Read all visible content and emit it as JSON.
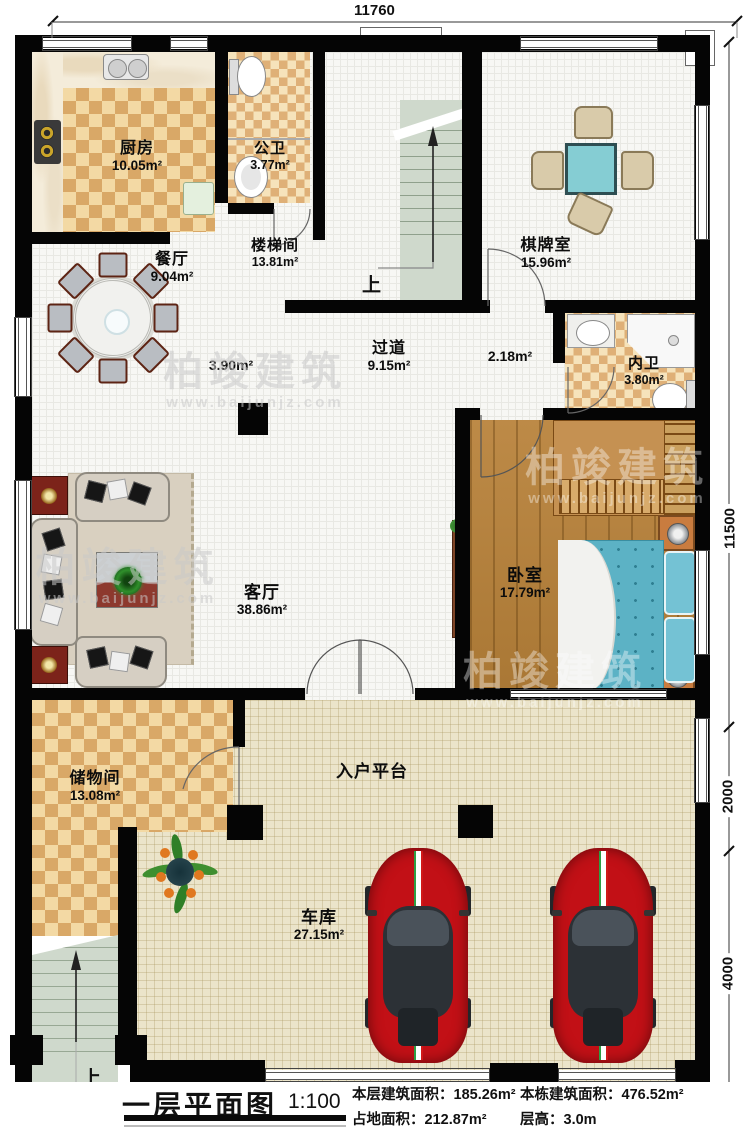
{
  "drawing": {
    "type": "floor-plan",
    "title": "一层平面图",
    "scale": "1:100"
  },
  "rooms": {
    "kitchen": {
      "name": "厨房",
      "area": "10.05m²"
    },
    "public_bath": {
      "name": "公卫",
      "area": "3.77m²"
    },
    "dining": {
      "name": "餐厅",
      "area": "9.04m²"
    },
    "stairwell": {
      "name": "楼梯间",
      "area": "13.81m²"
    },
    "chess": {
      "name": "棋牌室",
      "area": "15.96m²"
    },
    "hallway": {
      "name": "过道",
      "area": "9.15m²"
    },
    "hallway_sub1": {
      "area": "3.90m²"
    },
    "hallway_sub2": {
      "area": "2.18m²"
    },
    "inner_bath": {
      "name": "内卫",
      "area": "3.80m²"
    },
    "bedroom": {
      "name": "卧室",
      "area": "17.79m²"
    },
    "living": {
      "name": "客厅",
      "area": "38.86m²"
    },
    "storage": {
      "name": "储物间",
      "area": "13.08m²"
    },
    "platform": {
      "name": "入户平台"
    },
    "garage": {
      "name": "车库",
      "area": "27.15m²"
    }
  },
  "stairs": {
    "up_label": "上"
  },
  "dimensions": {
    "top": "11760",
    "right_upper": "11500",
    "right_mid": "2000",
    "right_lower": "4000"
  },
  "title_block": {
    "title": "一层平面图",
    "scale": "1:100",
    "floor_area_label": "本层建筑面积：",
    "floor_area_value": "185.26m²",
    "footprint_label": "占地面积：",
    "footprint_value": "212.87m²",
    "total_area_label": "本栋建筑面积：",
    "total_area_value": "476.52m²",
    "storey_height_label": "层高：",
    "storey_height_value": "3.0m"
  },
  "watermark": {
    "brand": "柏竣建筑",
    "site": "www.baijunjz.com"
  },
  "colors": {
    "wall": "#050505",
    "checker_dark": "#d9a867",
    "checker_light": "#f3d9a4",
    "wood_floor": "#b5813f",
    "bed": "#5cb2c5",
    "stair": "#cfd9cc",
    "garage_floor": "#ebe4ca",
    "car": "#c21016",
    "chess_table": "#85cdd3",
    "red_cabinet": "#7c231a",
    "watermark": "#c9c9c9"
  }
}
